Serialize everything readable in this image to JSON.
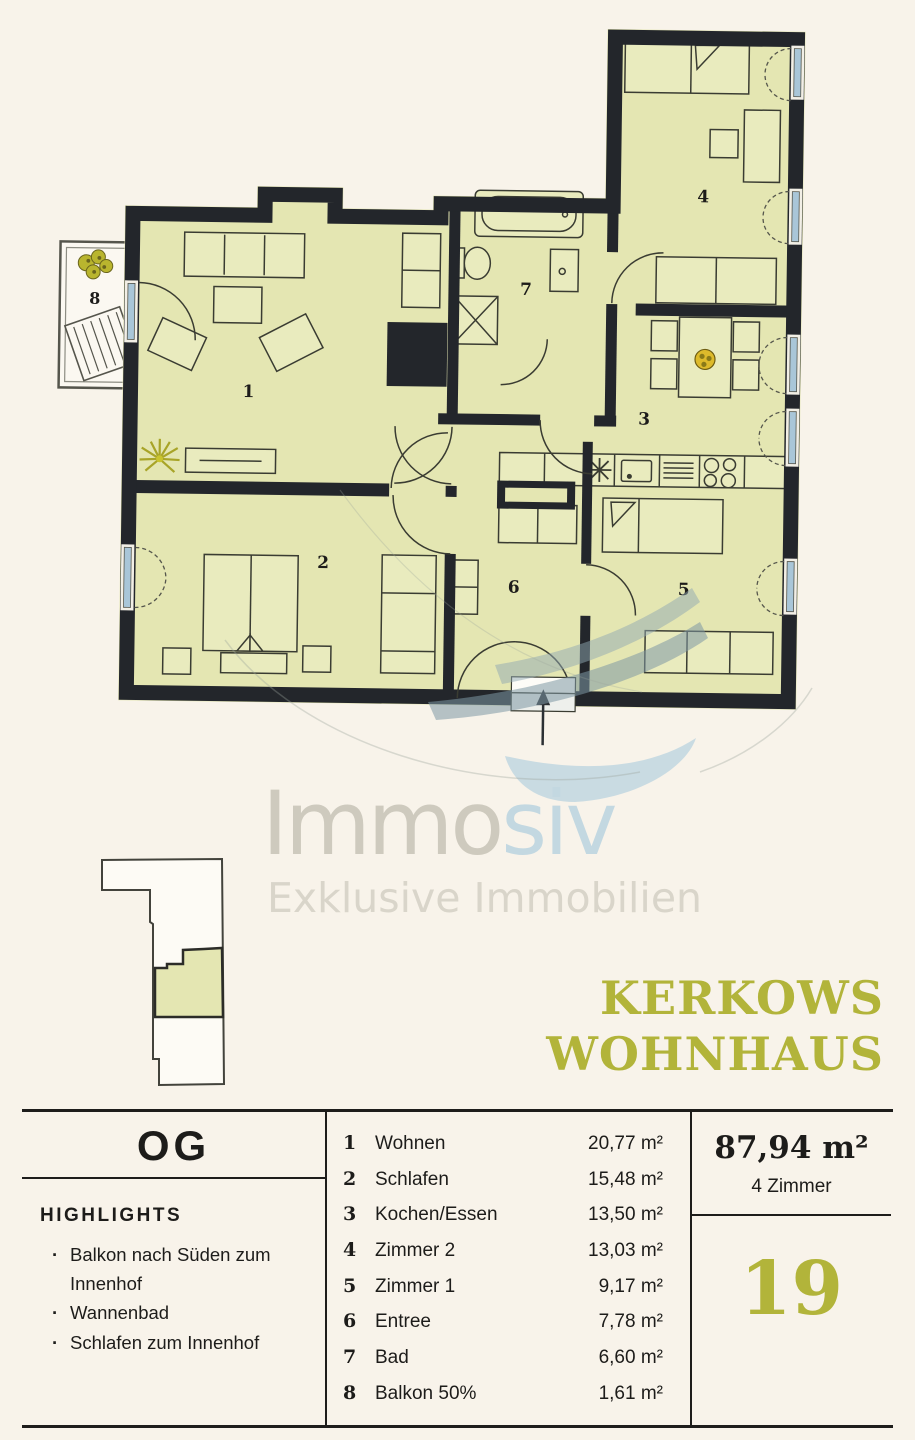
{
  "colors": {
    "background": "#f8f3ea",
    "plan_fill": "#e4e6b2",
    "wall": "#23262b",
    "window_blue": "#a9c6d8",
    "accent_olive": "#b2b43a",
    "logo_gray": "#cecabe",
    "logo_blue": "#c3d8e1",
    "text": "#1d1c1a"
  },
  "logo": {
    "text_primary": "Immo",
    "text_secondary": "siv",
    "tagline": "Exklusive Immobilien"
  },
  "title": {
    "line1": "KERKOWS",
    "line2": "WOHNHAUS"
  },
  "info": {
    "floor": "OG",
    "highlights_heading": "HIGHLIGHTS",
    "bullet": "·",
    "highlights": [
      "Balkon nach Süden zum Innenhof",
      "Wannenbad",
      "Schlafen zum Innenhof"
    ],
    "rooms": [
      {
        "number": "1",
        "label": "Wohnen",
        "area": "20,77 m²"
      },
      {
        "number": "2",
        "label": "Schlafen",
        "area": "15,48 m²"
      },
      {
        "number": "3",
        "label": "Kochen/Essen",
        "area": "13,50 m²"
      },
      {
        "number": "4",
        "label": "Zimmer 2",
        "area": "13,03 m²"
      },
      {
        "number": "5",
        "label": "Zimmer 1",
        "area": "9,17 m²"
      },
      {
        "number": "6",
        "label": "Entree",
        "area": "7,78 m²"
      },
      {
        "number": "7",
        "label": "Bad",
        "area": "6,60 m²"
      },
      {
        "number": "8",
        "label": "Balkon 50%",
        "area": "1,61 m²"
      }
    ],
    "total_area": "87,94 m²",
    "rooms_summary": "4 Zimmer",
    "unit_number": "19"
  }
}
